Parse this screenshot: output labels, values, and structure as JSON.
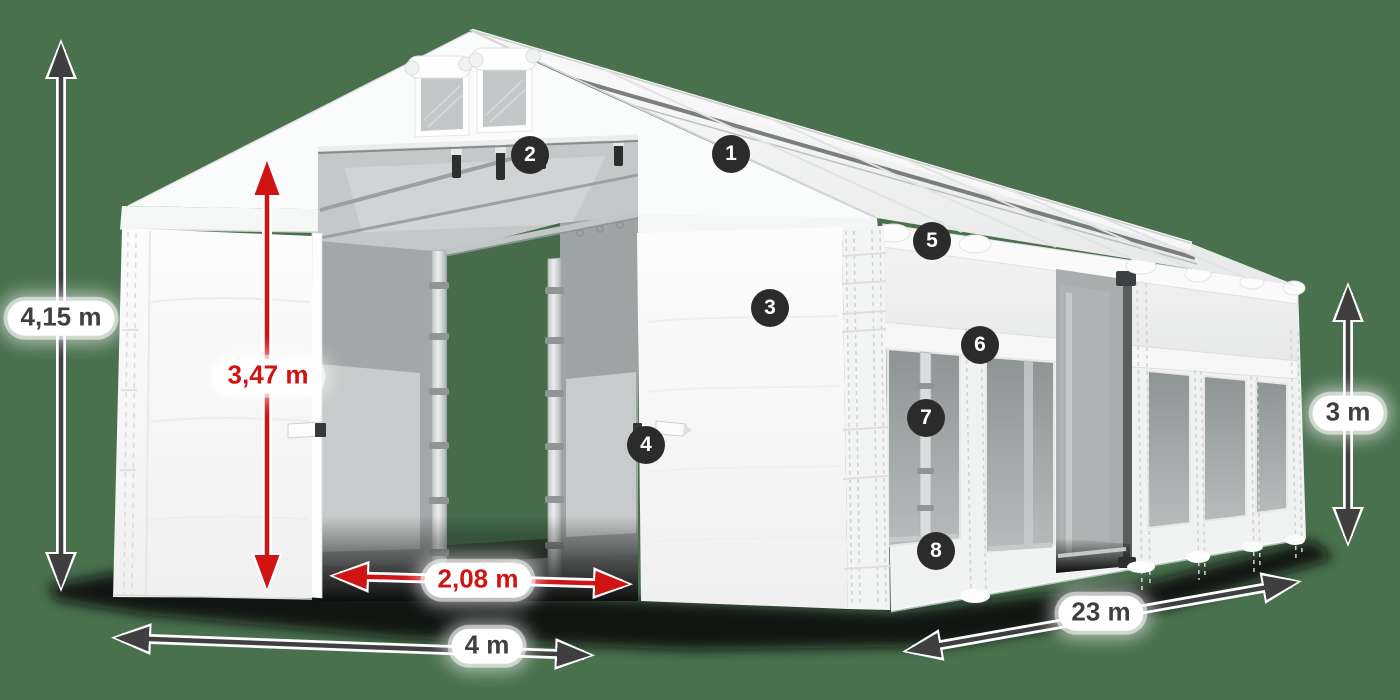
{
  "scene": {
    "background_color": "#49714E",
    "shadow_color": "#0A0A0A",
    "tent_white": "#FBFBFB",
    "accent_red": "#D01414",
    "accent_dark": "#3F3F3F",
    "badge_color": "#2B2B2B"
  },
  "dimensions": {
    "total_height": {
      "label": "4,15 m",
      "style": "dark"
    },
    "entrance_height": {
      "label": "3,47 m",
      "style": "red"
    },
    "entrance_width": {
      "label": "2,08 m",
      "style": "red"
    },
    "front_width": {
      "label": "4 m",
      "style": "dark"
    },
    "side_length": {
      "label": "23 m",
      "style": "dark"
    },
    "side_height": {
      "label": "3 m",
      "style": "dark"
    }
  },
  "badges": [
    {
      "number": "1"
    },
    {
      "number": "2"
    },
    {
      "number": "3"
    },
    {
      "number": "4"
    },
    {
      "number": "5"
    },
    {
      "number": "6"
    },
    {
      "number": "7"
    },
    {
      "number": "8"
    }
  ]
}
